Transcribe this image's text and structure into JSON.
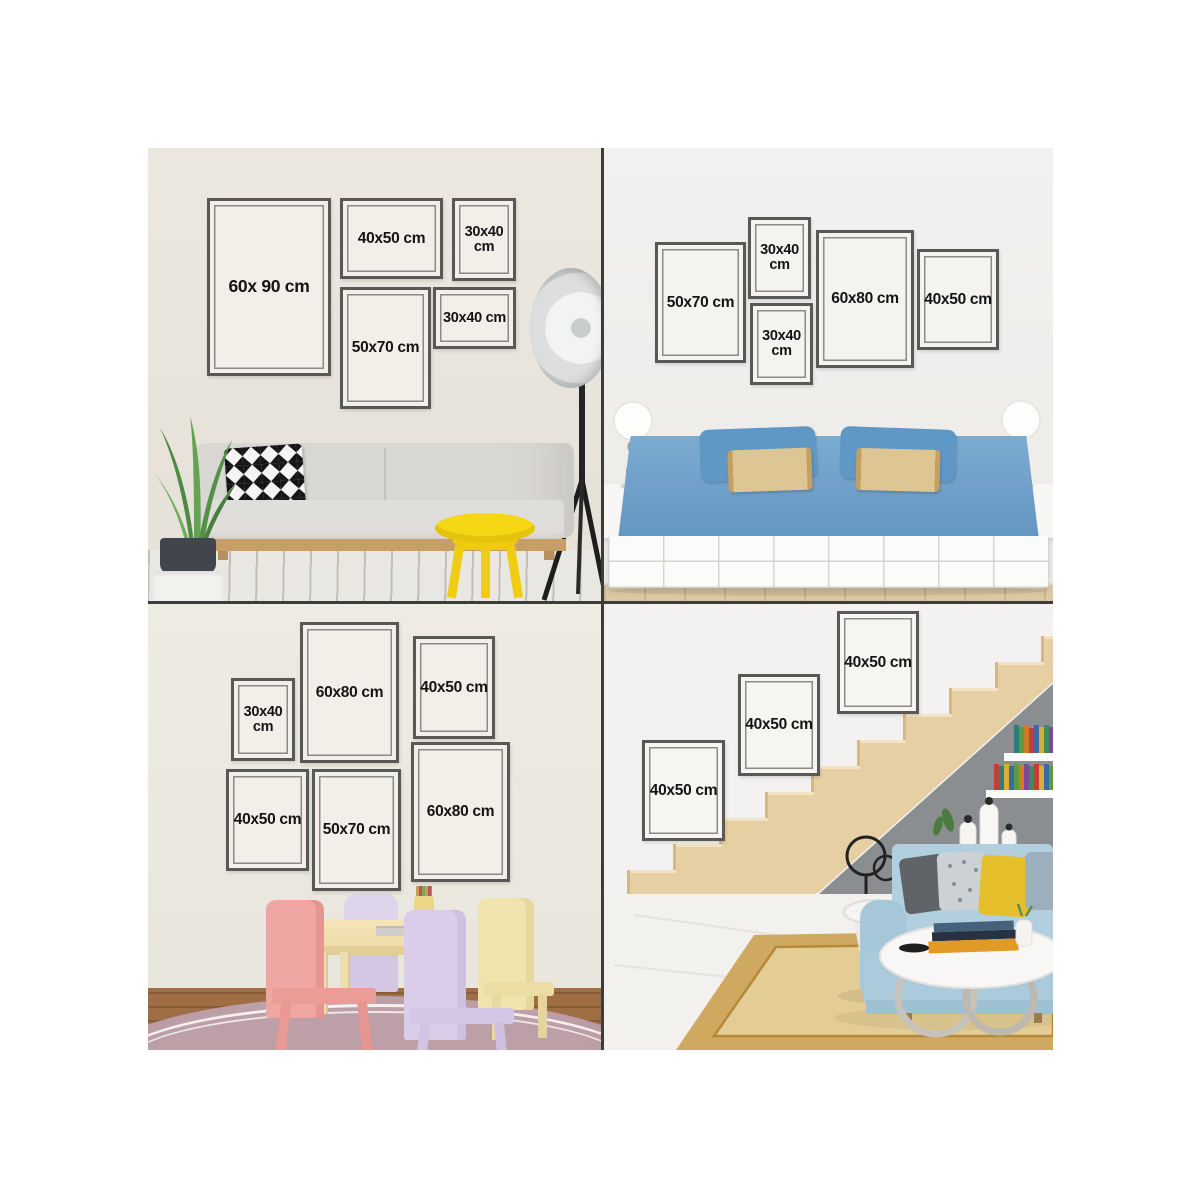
{
  "collage": {
    "palette": {
      "frame_border": "#585856",
      "frame_label": "#141414",
      "seam": "#3c3c3a",
      "tl_wall": "#eae6de",
      "tr_wall": "#f1f0ee",
      "bl_wall": "#ece9e1",
      "br_wall": "#f3f2f0"
    },
    "quadrants": [
      {
        "name": "living-room",
        "frames": [
          {
            "size": "60x90",
            "label": "60x 90 cm"
          },
          {
            "size": "40x50",
            "label": "40x50 cm"
          },
          {
            "size": "30x40",
            "label": "30x40 cm"
          },
          {
            "size": "50x70",
            "label": "50x70 cm"
          },
          {
            "size": "30x40",
            "label": "30x40 cm"
          }
        ]
      },
      {
        "name": "bedroom",
        "frames": [
          {
            "size": "50x70",
            "label": "50x70 cm"
          },
          {
            "size": "30x40",
            "label": "30x40 cm"
          },
          {
            "size": "30x40",
            "label": "30x40 cm"
          },
          {
            "size": "60x80",
            "label": "60x80 cm"
          },
          {
            "size": "40x50",
            "label": "40x50 cm"
          }
        ]
      },
      {
        "name": "kids-room",
        "frames": [
          {
            "size": "30x40",
            "label": "30x40 cm"
          },
          {
            "size": "60x80",
            "label": "60x80 cm"
          },
          {
            "size": "40x50",
            "label": "40x50 cm"
          },
          {
            "size": "40x50",
            "label": "40x50 cm"
          },
          {
            "size": "50x70",
            "label": "50x70 cm"
          },
          {
            "size": "60x80",
            "label": "60x80 cm"
          }
        ]
      },
      {
        "name": "staircase",
        "frames": [
          {
            "size": "40x50",
            "label": "40x50 cm"
          },
          {
            "size": "40x50",
            "label": "40x50 cm"
          },
          {
            "size": "40x50",
            "label": "40x50 cm"
          }
        ]
      }
    ]
  }
}
